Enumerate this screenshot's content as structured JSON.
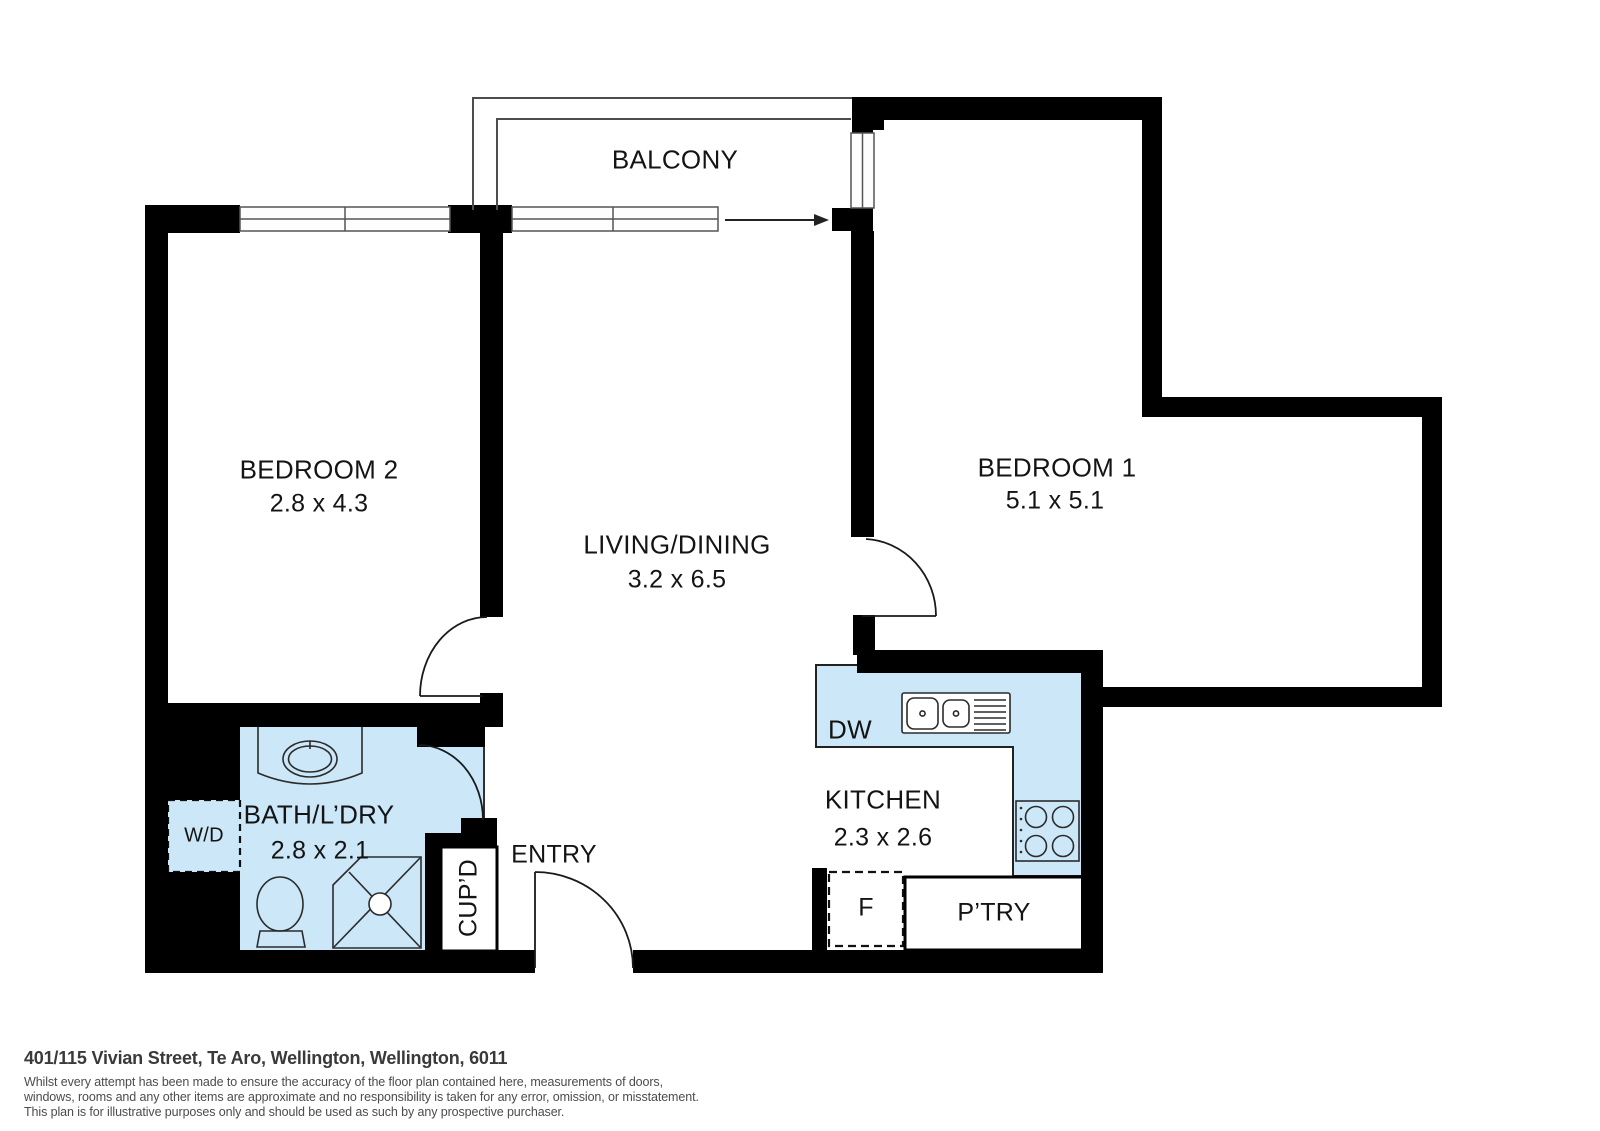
{
  "floorplan": {
    "balcony": {
      "label": "BALCONY"
    },
    "bedroom2": {
      "label": "BEDROOM 2",
      "dims": "2.8 x 4.3"
    },
    "bedroom1": {
      "label": "BEDROOM 1",
      "dims": "5.1 x 5.1"
    },
    "living_dining": {
      "label": "LIVING/DINING",
      "dims": "3.2 x 6.5"
    },
    "kitchen": {
      "label": "KITCHEN",
      "dims": "2.3 x 2.6"
    },
    "bath_laundry": {
      "label": "BATH/L’DRY",
      "dims": "2.8 x 2.1"
    },
    "entry": {
      "label": "ENTRY"
    },
    "fixtures": {
      "washer_dryer": "W/D",
      "dishwasher": "DW",
      "fridge": "F",
      "pantry": "P’TRY",
      "cupboard": "CUP’D"
    },
    "colors": {
      "wall": "#000000",
      "wet_area_fill": "#cbe7f8",
      "outline": "#2b2b2b"
    }
  },
  "footer": {
    "address": "401/115 Vivian Street, Te Aro, Wellington, Wellington, 6011",
    "disclaimer_lines": [
      "Whilst every attempt has been made to ensure the accuracy of the floor plan contained here, measurements of doors,",
      "windows, rooms and any other items are approximate and no responsibility is taken for any error, omission, or misstatement.",
      "This plan is for illustrative purposes only and should be used as such by any prospective purchaser."
    ]
  }
}
